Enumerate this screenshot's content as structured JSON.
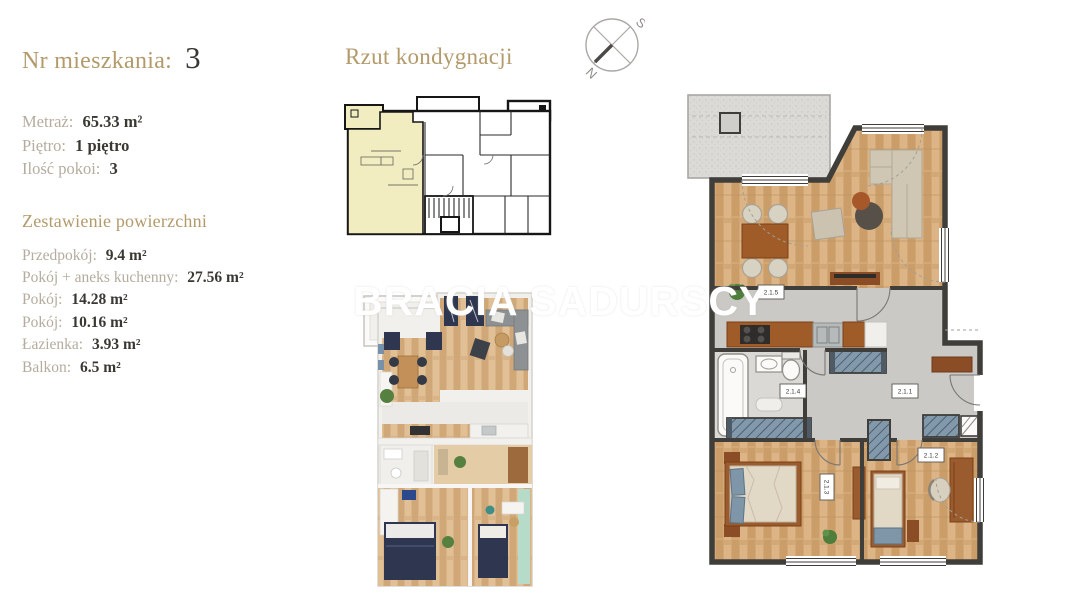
{
  "header": {
    "apartment_label": "Nr mieszkania:",
    "apartment_number": "3"
  },
  "details": {
    "items": [
      {
        "label": "Metraż:",
        "value": "65.33 m²"
      },
      {
        "label": "Piętro:",
        "value": "1 piętro"
      },
      {
        "label": "Ilość pokoi:",
        "value": "3"
      }
    ]
  },
  "areas": {
    "heading": "Zestawienie powierzchni",
    "items": [
      {
        "label": "Przedpokój:",
        "value": "9.4 m²"
      },
      {
        "label": "Pokój + aneks kuchenny:",
        "value": "27.56 m²"
      },
      {
        "label": "Pokój:",
        "value": "14.28 m²"
      },
      {
        "label": "Pokój:",
        "value": "10.16 m²"
      },
      {
        "label": "Łazienka:",
        "value": "3.93 m²"
      },
      {
        "label": "Balkon:",
        "value": "6.5 m²"
      }
    ]
  },
  "floor_section": {
    "heading": "Rzut kondygnacji"
  },
  "compass": {
    "north": "N",
    "south": "S"
  },
  "watermark": {
    "text": "BRACIA SADURSCY"
  },
  "main_plan": {
    "room_labels": [
      "2.1.5",
      "2.1.4",
      "2.1.1",
      "2.1.3",
      "2.1.2"
    ]
  },
  "colors": {
    "accent_gold": "#b39a6b",
    "label_gray": "#b5ac9e",
    "value_dark": "#3b3833",
    "highlight_yellow": "#f2edc0",
    "wood_floor": "#d2a878",
    "corridor_gray": "#cac9c5",
    "wardrobe_blue": "#7e96a8",
    "wall_dark": "#403e3a"
  }
}
